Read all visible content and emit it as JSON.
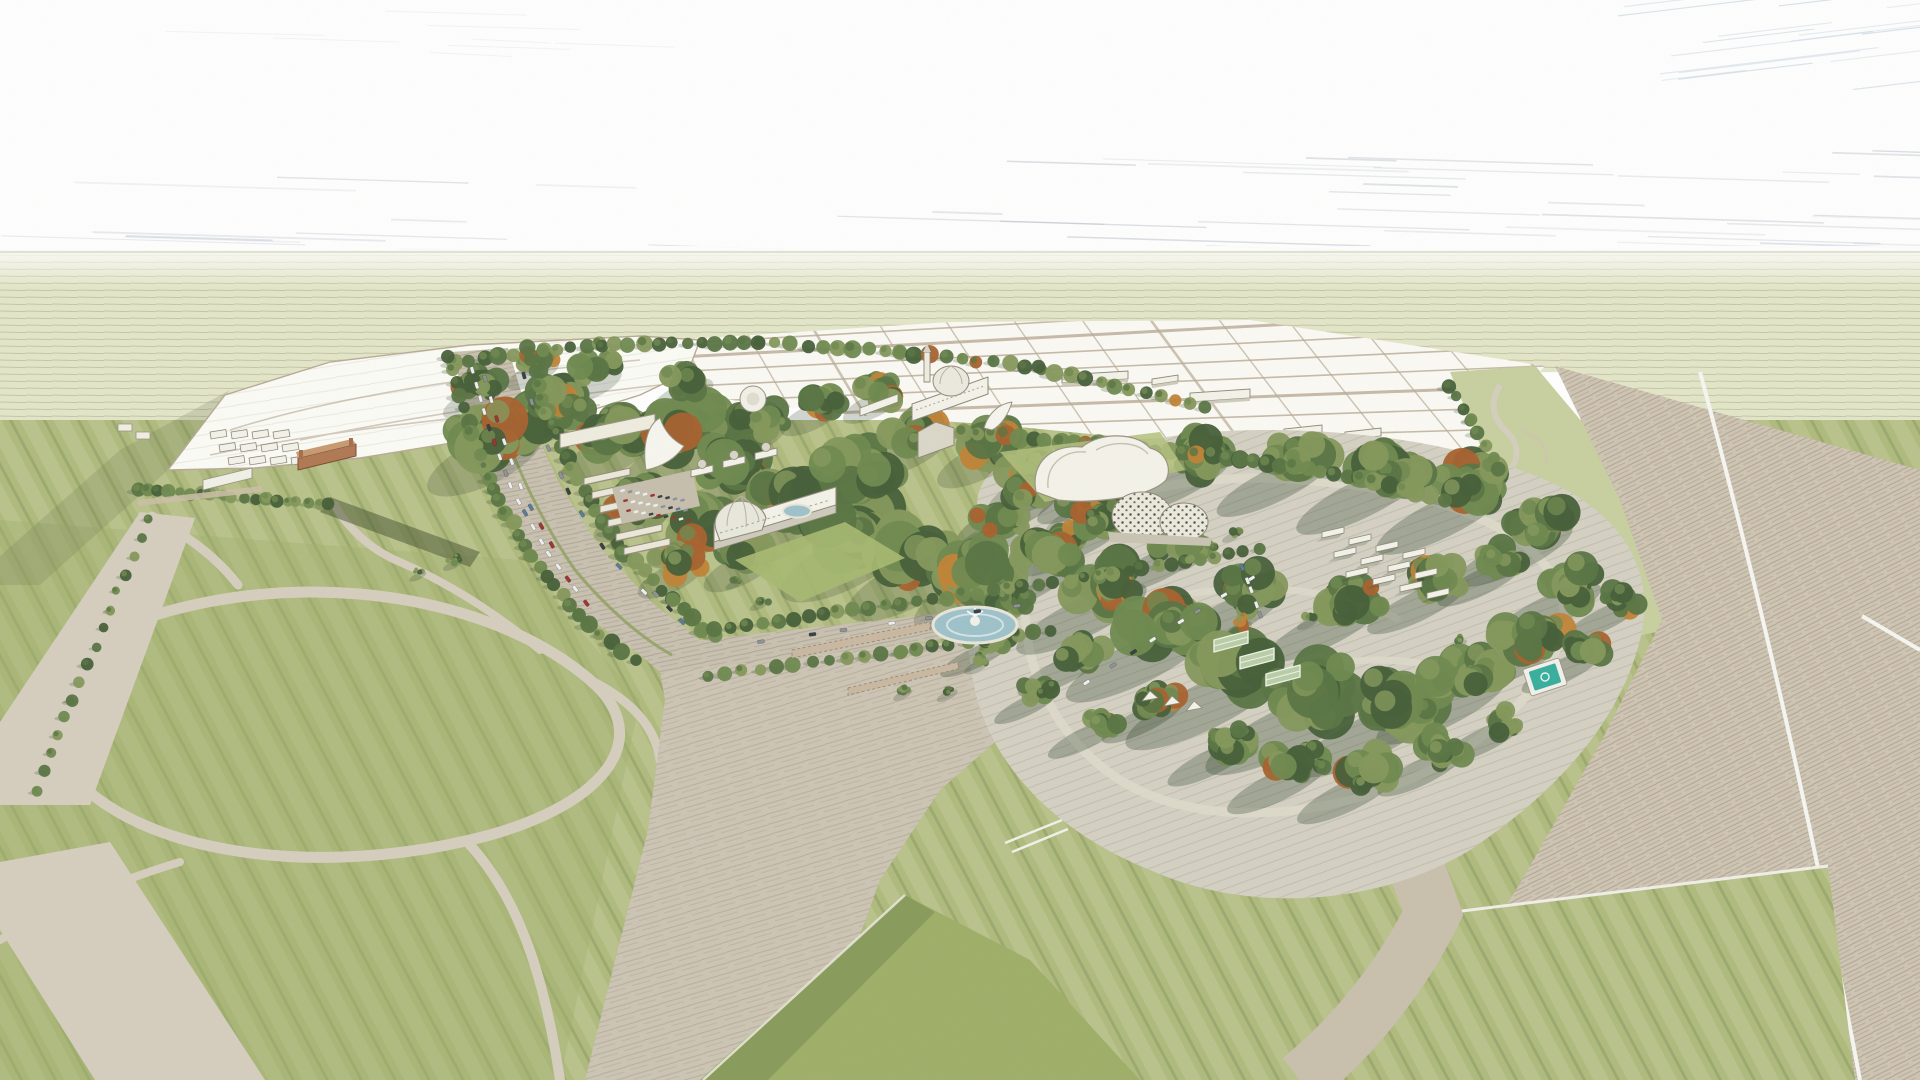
{
  "scene": {
    "kind": "hand-sketch aerial rendering of a parkland masterplan",
    "landmarks": [
      "historic-fair-cluster-west",
      "exhibition-basilica-ribbed-dome",
      "domed-museum-with-tower",
      "bandshell-canopy",
      "curved-roof-arena",
      "geodesic-lattice-pavilion",
      "circular-fountain-pond",
      "tree-lined-boulevard-with-traffic",
      "arcade-colonnades",
      "woodland-garden-with-teal-pool",
      "greenhouse-sheds",
      "serpentine-linear-park",
      "agricultural-parcel-grid",
      "great-lawns-with-mowing-stripes",
      "esplanade-intersection",
      "perimeter-highway"
    ]
  },
  "colors": {
    "sky": "#ffffff",
    "skyHatch": "#b4bcc6",
    "skyHatchBlue": "#9db7cb",
    "distantField": "#e4e6c9",
    "distantLine": "#c3caa2",
    "lawnBase": "#b0bb7e",
    "lawnBright": "#9fb06a",
    "lawnDarkEdge": "#6f844c",
    "treeDark": "#47603a",
    "treeMid": "#5a7544",
    "treeLight": "#6f8a50",
    "treeOlive": "#85985c",
    "treeOrange": "#c08437",
    "treeRust": "#a9622f",
    "treeShadow": "#32452e",
    "roadTan": "#d6cfbf",
    "roadEdge": "#a89f8e",
    "pavement": "#c9c1b1",
    "plaza": "#cdc5b5",
    "apron": "#cfc5b4",
    "gravel": "#d5d1c3",
    "gravelPath": "#dedacb",
    "whiteSite": "#fcfcf7",
    "parcelFill": "#fbfaf4",
    "parcelLine": "#b9ab97",
    "buildingWhite": "#f4f3ea",
    "buildingShade": "#cfccbd",
    "buildingStroke": "#8f8a7a",
    "brick": "#b07a54",
    "brickDark": "#7d4e33",
    "dome": "#e9e8dd",
    "water": "#9fc2ca",
    "poolTeal": "#3aaf9f",
    "stripeWhite": "#f6f6f2",
    "carWhite": "#eef0f2",
    "carGrey": "#8d9399",
    "carDark": "#3a3f46",
    "carRed": "#9e3430",
    "carBlue": "#5a7b9e"
  }
}
